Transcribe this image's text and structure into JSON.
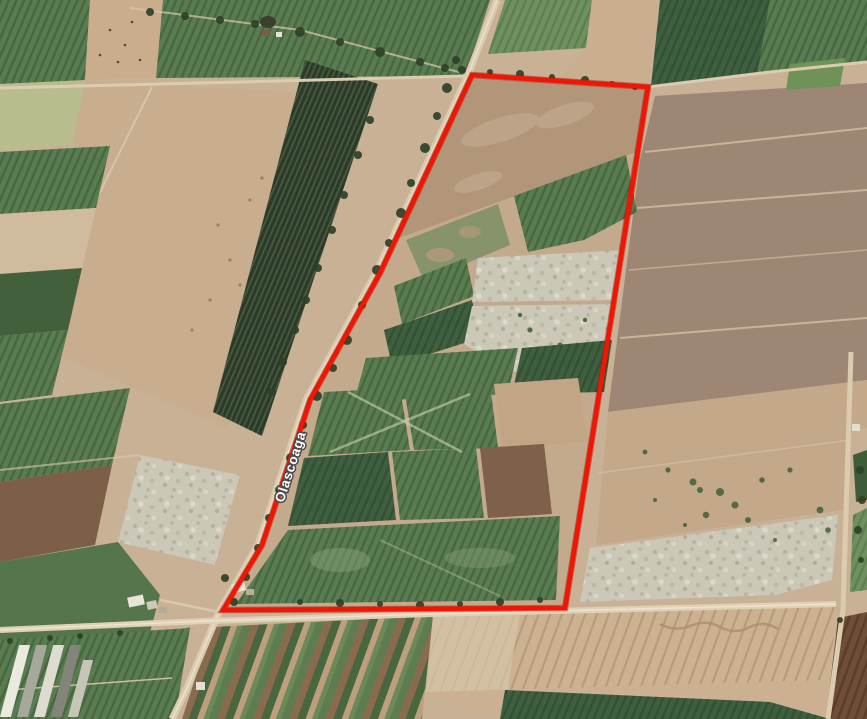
{
  "map": {
    "view": "satellite-imagery",
    "description": "Aerial view of irrigated farmland parcels with a red property-boundary outline drawn along a rural road",
    "road_label": "Olascoaga",
    "boundary": {
      "color": "#ee1605",
      "underlay_color": "#a50e02",
      "stroke_width": 4.6,
      "points": "472,75 648,87 565,608 223,610 262,545 310,400 380,273"
    },
    "label_rotation_deg": -72,
    "palette": {
      "crop_green": "#5a7c52",
      "crop_green_dark": "#3f6040",
      "vineyard_dark": "#2c3a29",
      "plowed_tan": "#c8ad8e",
      "fallow_mauve": "#9d8673",
      "bare_white": "#ccc8b8",
      "road": "#dccdb1",
      "trees": "#2e4128"
    }
  }
}
